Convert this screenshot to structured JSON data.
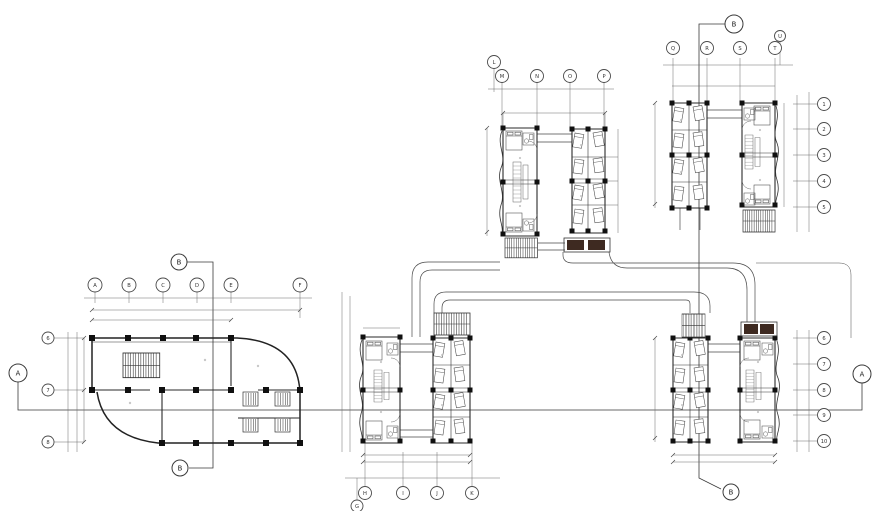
{
  "drawing": {
    "kind": "architectural-floor-plan",
    "section_labels": {
      "a": "A",
      "b": "B"
    },
    "grids": {
      "block1_top": [
        "A",
        "B",
        "C",
        "D",
        "E",
        "F"
      ],
      "block1_left": [
        "6",
        "7",
        "8"
      ],
      "block2_top": [
        "L",
        "M",
        "N",
        "O",
        "P"
      ],
      "block3_top": [
        "Q",
        "R",
        "S",
        "T",
        "U"
      ],
      "right_upper": [
        "1",
        "2",
        "3",
        "4",
        "5"
      ],
      "right_lower": [
        "6",
        "7",
        "8",
        "9",
        "10"
      ],
      "block4_bottom": [
        "G",
        "H",
        "I",
        "J",
        "K"
      ]
    },
    "colors": {
      "line": "#2f2f2f",
      "thin_line": "#6a6a6a",
      "column_fill": "#101010",
      "porch_fill": "#3e2a21",
      "background": "#ffffff"
    }
  }
}
